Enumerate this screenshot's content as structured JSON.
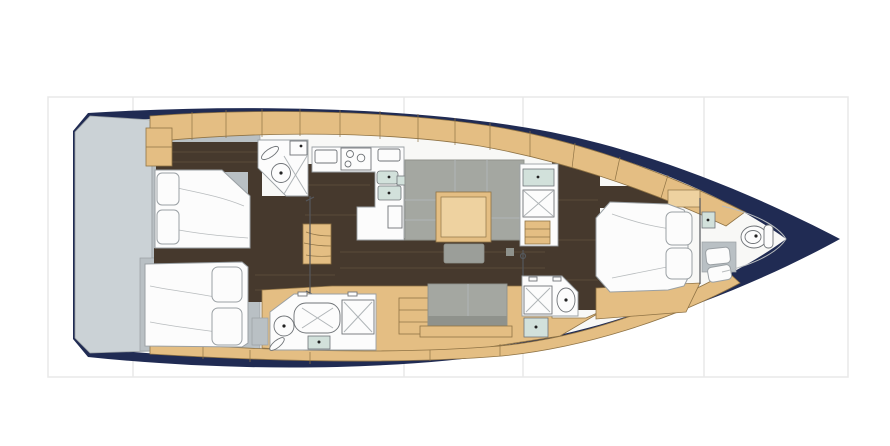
{
  "canvas": {
    "width": 890,
    "height": 446,
    "background": "#ffffff"
  },
  "frame": {
    "x": 48,
    "y": 97,
    "width": 800,
    "height": 280,
    "line_color": "#e8e8e8",
    "column_lines_x": [
      133,
      404,
      523,
      704
    ]
  },
  "colors": {
    "hull": "#202b53",
    "deck": "#f8f8f6",
    "platform": "#cbd2d6",
    "wall": "#b9c0c4",
    "floor": "#46392d",
    "streak": "#5a4a39",
    "wood": "#e4be83",
    "woodlight": "#eed2a0",
    "woodedge": "#8f7345",
    "room": "#fcfcfc",
    "outline": "#9aa0a4",
    "fixture": "#707478",
    "sink": "#d2e1db",
    "sofa": "#a4a7a1",
    "sofadark": "#8f928c",
    "stool": "#9b9e99",
    "xline": "#b0b5b8",
    "frame": "#e8e8e8",
    "liner": "#b8bcbe"
  },
  "drawing": {
    "type": "yacht-interior-floor-plan",
    "orientation": "bow-right"
  },
  "rooms": [
    "swim-platform",
    "starboard-aft-cabin",
    "port-aft-cabin",
    "starboard-aft-head",
    "port-aft-head",
    "galley",
    "salon",
    "companionway-steps",
    "starboard-mid-head",
    "port-mid-head",
    "owner-cabin",
    "forward-head"
  ]
}
